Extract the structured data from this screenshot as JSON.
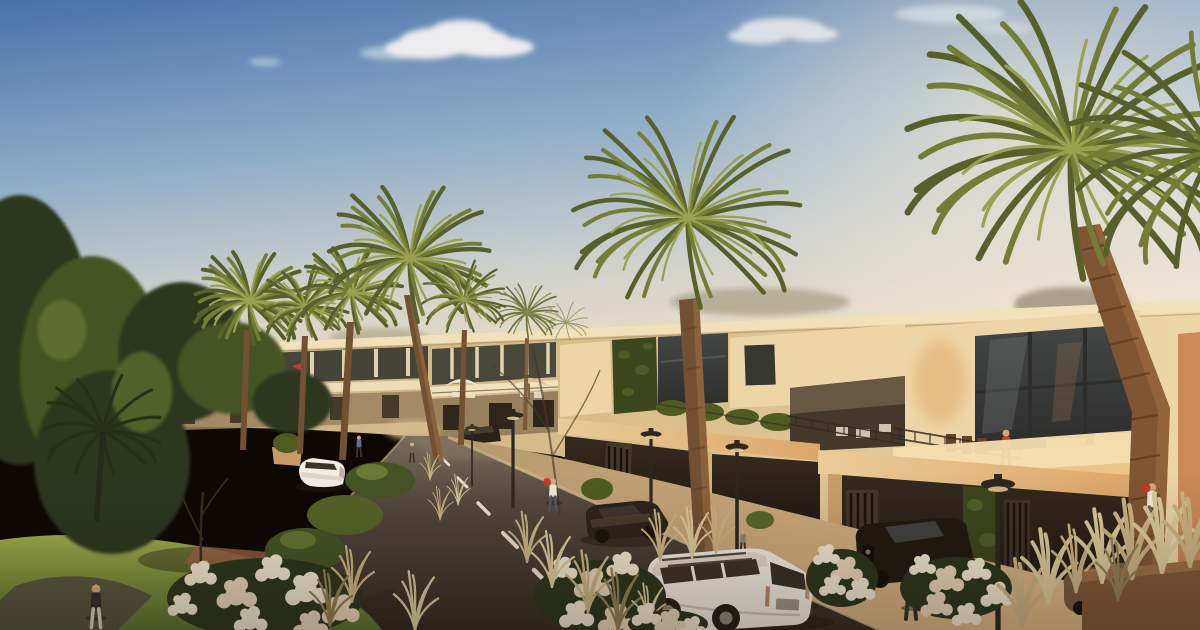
{
  "meta": {
    "type": "architectural-render",
    "width": 1200,
    "height": 630
  },
  "scene": {
    "setting": "sunlit residential street of modern two-storey townhouses lined with palm trees",
    "objects": {
      "building_row": "beige townhouses with roof terraces, glass walls and carports",
      "palm_trees": 10,
      "street_lamps": 5,
      "umbrellas": 2,
      "red_flag": 1,
      "vehicles": [
        "white suv",
        "white sedan",
        "dark parked sedan",
        "black carport suv",
        "bronze sedan",
        "dark driveway car"
      ],
      "people": 10,
      "landscaping": [
        "white flower bushes",
        "pampas grass tufts",
        "lawn",
        "gravel path",
        "planters",
        "dense trees"
      ]
    },
    "colors": {
      "sky_top": "#3f6fae",
      "sky_mid": "#7fa7cc",
      "sky_pale": "#c6cfd2",
      "sky_horizon": "#e3ddcb",
      "cloud": "#ffffff",
      "glow": "#fff3d8",
      "parapet": "#f2e6c2",
      "facade_light": "#ecd9ad",
      "facade_mid": "#d9c191",
      "facade_far": "#c6b288",
      "facade_shadow": "#93805f",
      "window_dark": "#2c332f",
      "glass_near": "#3a4246",
      "glass_frame": "#22272a",
      "wood_soffit": "#dca76a",
      "carport_dark": "#1d1813",
      "louver_dark": "#0d0b09",
      "ivy_green": "#33431c",
      "hedge_green": "#46581f",
      "road_far": "#73695c",
      "road_mid": "#4a443d",
      "road_near": "#2c2823",
      "lane_mark": "#e9e5d9",
      "curb": "#d8bf94",
      "sidewalk_far": "#b09770",
      "sidewalk_near": "#e0ba8a",
      "paver_red": "#a97a58",
      "lawn_light": "#9cb04c",
      "lawn_dark": "#54702c",
      "veg_dark": "#22311a",
      "veg_mid": "#3c5122",
      "veg_light": "#7d9440",
      "frond_dark": "#4e5d2a",
      "frond_mid": "#6d7c35",
      "frond_light": "#95a252",
      "trunk": "#6b4c31",
      "trunk_light": "#9c7046",
      "trunk_big": "#7a5232",
      "flower": "#f3ecd9",
      "flower_warm": "#ead9c0",
      "grass_tan": "#cbb687",
      "grass_pale": "#ddcda0",
      "grass_dark": "#8f7f56",
      "car_white": "#f4f2ec",
      "car_dark": "#211e1b",
      "car_bronze": "#71583d",
      "accent_red": "#c03a2e",
      "lamp_dark": "#23211d",
      "shadow": "#17140f",
      "skin": "#d2a87e"
    }
  }
}
